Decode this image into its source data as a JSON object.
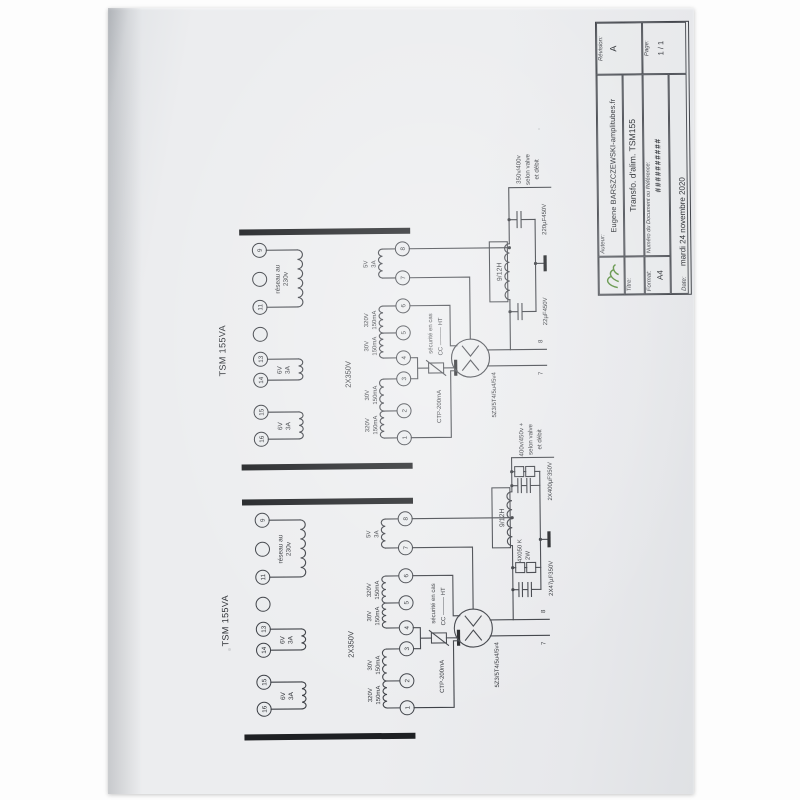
{
  "colors": {
    "ink": "#3a3d42",
    "paper": "#e8eaec",
    "logo_green": "#5e9143"
  },
  "titleblock": {
    "author_label": "Auteur:",
    "author": "Eugene BARSZCZEWSKI-amplitubes.fr",
    "revision_label": "Révision:",
    "revision": "A",
    "title_label": "Titre:",
    "title": "Transfo. d'alim. TSM155",
    "format_label": "Format:",
    "format": "A4",
    "docnum_label": "Numéro du Document ou Référence:",
    "docnum": "##########",
    "page_label": "Page:",
    "page": "1 / 1",
    "date_label": "Date:",
    "date": "mardi 24 novembre 2020",
    "logo_name": "dessinateur-logo"
  },
  "psu_a": {
    "transformer_name": "TSM 155VA",
    "primary_terminals": [
      "16",
      "15",
      "14",
      "13",
      "",
      "11",
      "",
      "9"
    ],
    "secondary_terminals": [
      "1",
      "2",
      "3",
      "4",
      "5",
      "6",
      "7",
      "8"
    ],
    "primary_windings": [
      [
        "6V",
        "3A"
      ],
      [
        "6V",
        "3A"
      ],
      [
        "réseau au",
        "230v"
      ]
    ],
    "secondary_windings": [
      [
        "320V",
        "150mA"
      ],
      [
        "30V",
        "150mA"
      ],
      [
        "30V",
        "150mA"
      ],
      [
        "320V",
        "150mA"
      ],
      [
        "5V",
        "3A"
      ]
    ],
    "ht_label": "2X350V",
    "ctp_label": "CTP-200mA",
    "security": [
      "sécurité en cas",
      "CC ——— HT"
    ],
    "tube_label": "5Z3/5T4/5u4/5v4",
    "choke_label": "9/12H",
    "cap_labels": [
      "22µF450V",
      "220µF450V"
    ],
    "pin7": "7",
    "pin8": "8",
    "output": [
      "350v/400v",
      "selon valve",
      "et débit"
    ]
  },
  "psu_b": {
    "transformer_name": "TSM 155VA",
    "primary_terminals": [
      "16",
      "15",
      "14",
      "13",
      "",
      "11",
      "",
      "9"
    ],
    "secondary_terminals": [
      "1",
      "2",
      "3",
      "4",
      "5",
      "6",
      "7",
      "8"
    ],
    "primary_windings": [
      [
        "6V",
        "3A"
      ],
      [
        "6V",
        "3A"
      ],
      [
        "réseau au",
        "230v"
      ]
    ],
    "secondary_windings": [
      [
        "320V",
        "150mA"
      ],
      [
        "30V",
        "150mA"
      ],
      [
        "30V",
        "150mA"
      ],
      [
        "320V",
        "150mA"
      ],
      [
        "5V",
        "3A"
      ]
    ],
    "ht_label": "2X350V",
    "ctp_label": "CTP-200mA",
    "security": [
      "sécurité en cas",
      "CC ——— HT"
    ],
    "tube_label": "5Z3/5T4/5u4/5v4",
    "choke_label": "9/12H",
    "bleeder": [
      "4X050 K",
      "2W"
    ],
    "bank1_label": "2X47µF350V",
    "bank2_label": "2X400µF350V",
    "pin7": "7",
    "pin8": "8",
    "output": [
      "400v/450v +",
      "selon valve",
      "et débit"
    ]
  }
}
